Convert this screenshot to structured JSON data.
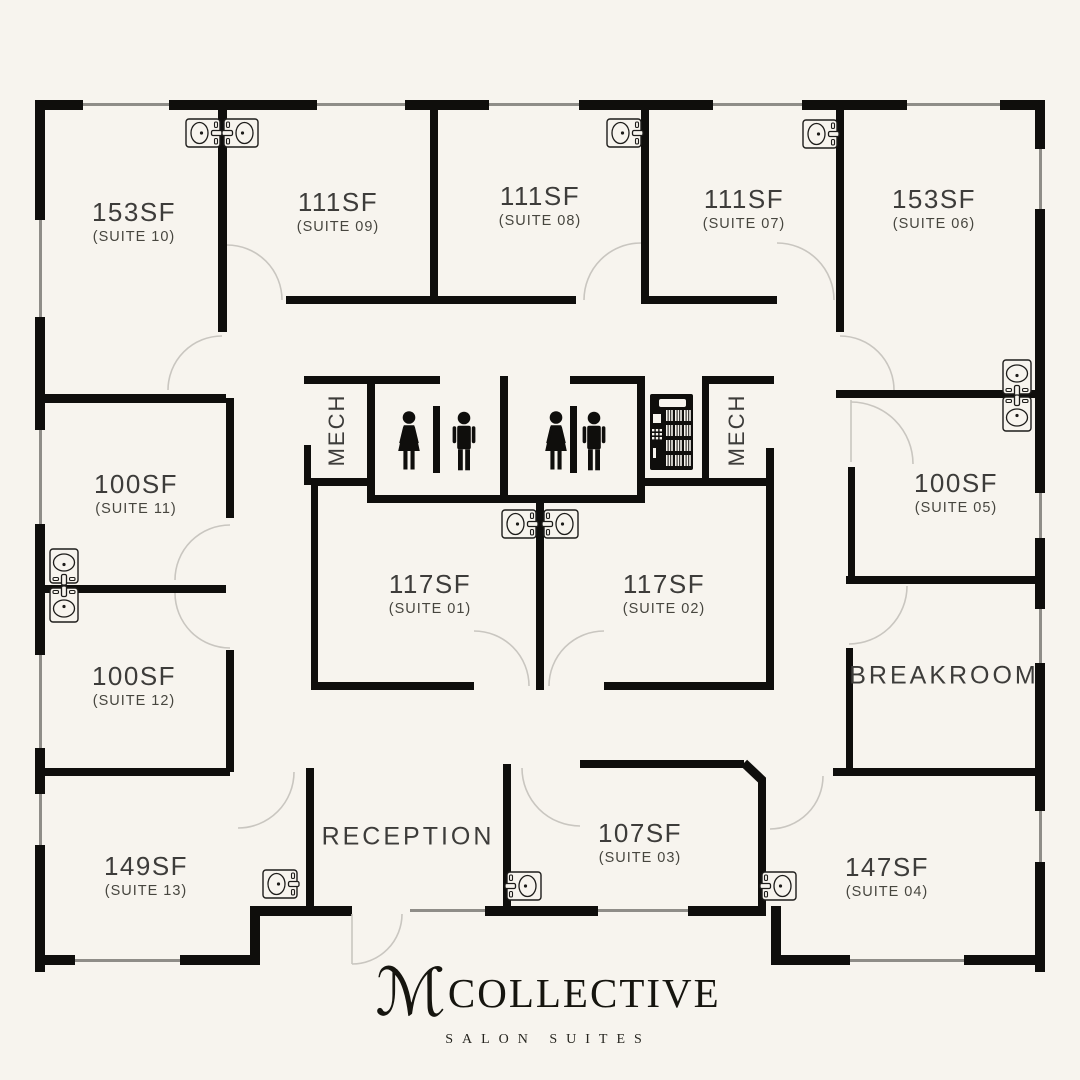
{
  "title": "M Collective Salon Suites floor plan",
  "colors": {
    "background": "#f7f4ee",
    "walls": "#0f0e0c",
    "label_text": "#3d3c3a",
    "door_arc": "#c9c6c0",
    "window_line": "#8f8d88"
  },
  "plan": {
    "suites": [
      {
        "sf": "153SF",
        "suite": "(SUITE 10)"
      },
      {
        "sf": "111SF",
        "suite": "(SUITE 09)"
      },
      {
        "sf": "111SF",
        "suite": "(SUITE 08)"
      },
      {
        "sf": "111SF",
        "suite": "(SUITE 07)"
      },
      {
        "sf": "153SF",
        "suite": "(SUITE 06)"
      },
      {
        "sf": "100SF",
        "suite": "(SUITE 11)"
      },
      {
        "sf": "100SF",
        "suite": "(SUITE 05)"
      },
      {
        "sf": "117SF",
        "suite": "(SUITE 01)"
      },
      {
        "sf": "117SF",
        "suite": "(SUITE 02)"
      },
      {
        "sf": "100SF",
        "suite": "(SUITE 12)"
      },
      {
        "sf": "149SF",
        "suite": "(SUITE 13)"
      },
      {
        "sf": "107SF",
        "suite": "(SUITE 03)"
      },
      {
        "sf": "147SF",
        "suite": "(SUITE 04)"
      }
    ],
    "rooms": {
      "reception": "RECEPTION",
      "breakroom": "BREAKROOM",
      "mech_left": "MECH",
      "mech_right": "MECH"
    },
    "icons": [
      "sink-icon",
      "restroom-women-icon",
      "restroom-men-icon",
      "vending-machine-icon",
      "door-swing-arc"
    ]
  },
  "logo": {
    "monogram": "ℳ",
    "name": "COLLECTIVE",
    "tagline": "SALON SUITES"
  }
}
